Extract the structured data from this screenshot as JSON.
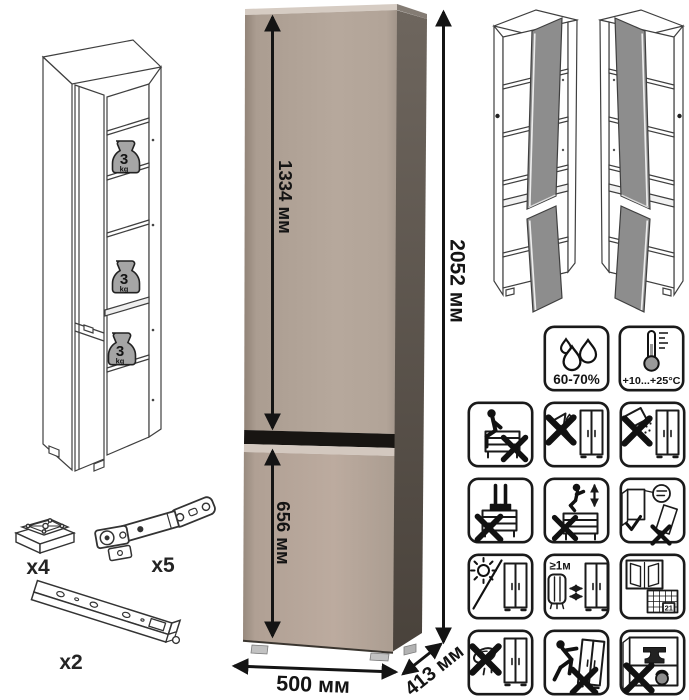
{
  "product": {
    "type": "tall cabinet spec sheet",
    "dimensions": {
      "upper_door_height": "1334 мм",
      "lower_door_height": "656 мм",
      "total_height": "2052 мм",
      "width": "500 мм",
      "depth": "413 мм"
    },
    "shelf_load": {
      "value": "3",
      "unit": "kg"
    },
    "climate": {
      "humidity": "60-70%",
      "temperature": "+10...+25°C"
    },
    "care": {
      "heater_distance": "≥1м",
      "calendar_day": "21",
      "icons": [
        "no-sitting",
        "no-solvent-cleaning",
        "no-abrasive-cleaning",
        "no-standing",
        "no-jumping",
        "assemble-upright-check",
        "avoid-direct-sunlight",
        "keep-1m-from-heaters",
        "ventilate-room",
        "no-wet-cloth",
        "no-dragging",
        "no-overloading"
      ]
    },
    "hardware": {
      "foot_count": "x4",
      "hinge_count": "x5",
      "rail_count": "x2"
    },
    "colors": {
      "front": "#b4a79b",
      "front_highlight": "#d6ccc3",
      "side": "#584f48",
      "door_gap": "#181512",
      "open_door_gray": "#8d8d8d",
      "line_art": "#3f3f3f",
      "text": "#141414"
    }
  }
}
